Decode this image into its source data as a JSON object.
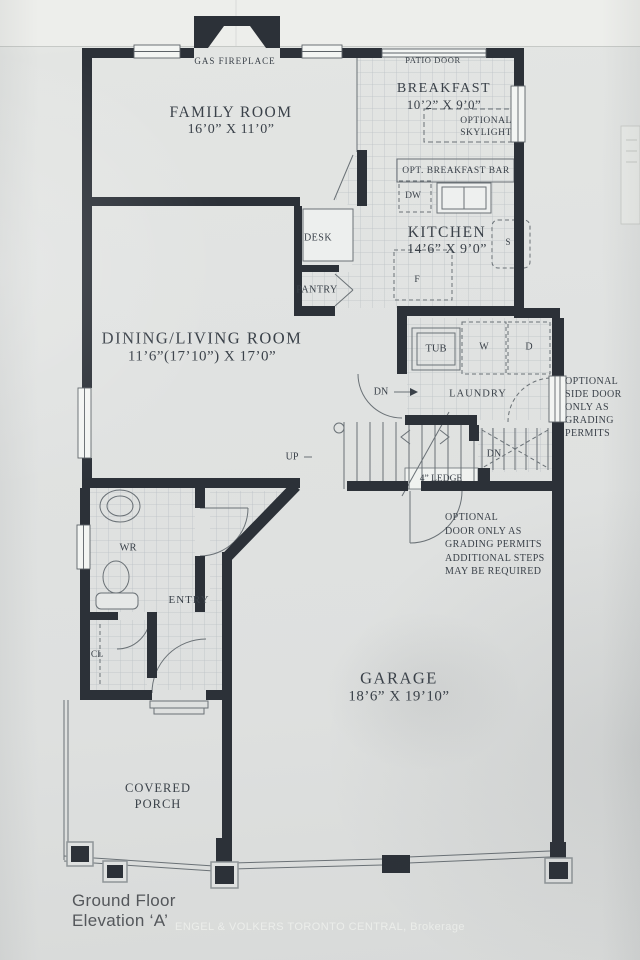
{
  "plan": {
    "rooms": {
      "family": {
        "name": "FAMILY ROOM",
        "dims": "16’0” X 11’0”"
      },
      "breakfast": {
        "name": "BREAKFAST",
        "dims": "10’2” X 9’0”"
      },
      "kitchen": {
        "name": "KITCHEN",
        "dims": "14’6” X 9’0”"
      },
      "dining": {
        "name": "DINING/LIVING ROOM",
        "dims": "11’6”(17’10”) X 17’0”"
      },
      "garage": {
        "name": "GARAGE",
        "dims": "18’6” X 19’10”"
      },
      "laundry": {
        "name": "LAUNDRY"
      },
      "entry": {
        "name": "ENTRY"
      },
      "wr": {
        "name": "WR"
      },
      "cl": {
        "name": "CL"
      },
      "porch": {
        "name": "COVERED\nPORCH"
      }
    },
    "features": {
      "gas_fireplace": "GAS FIREPLACE",
      "patio_door": "PATIO DOOR",
      "optional_skylight": "OPTIONAL\nSKYLIGHT",
      "opt_breakfast_bar": "OPT. BREAKFAST BAR",
      "dishwasher": "DW",
      "stove": "S",
      "fridge": "F",
      "desk": "DESK",
      "pantry": "PANTRY",
      "tub": "TUB",
      "washer": "W",
      "dryer": "D",
      "dn_hall": "DN",
      "dn_stair": "DN",
      "up": "UP",
      "ledge": "4” LEDGE"
    },
    "notes": {
      "side_door": "OPTIONAL\nSIDE DOOR\nONLY AS\nGRADING\nPERMITS",
      "garage_door": "OPTIONAL\nDOOR ONLY AS\nGRADING PERMITS\nADDITIONAL STEPS\nMAY BE REQUIRED"
    }
  },
  "footer": {
    "title": "Ground Floor\nElevation ‘A’",
    "watermark": "ENGEL & VOLKERS TORONTO CENTRAL, Brokerage"
  },
  "colors": {
    "wall": "#2c3138",
    "paper": "#e0e2e1",
    "ink": "#3a4149"
  }
}
